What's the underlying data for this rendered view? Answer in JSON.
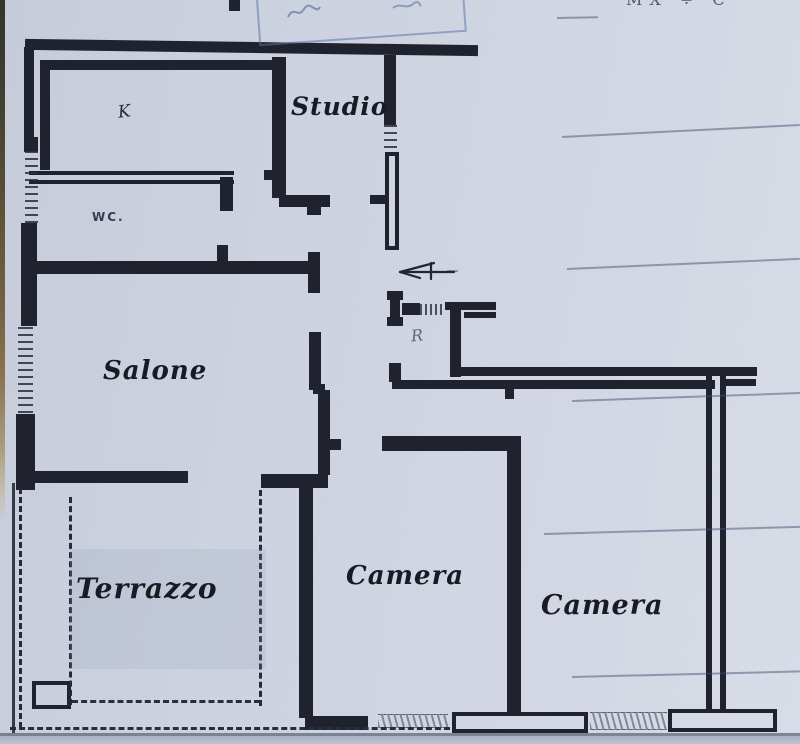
{
  "document": {
    "type": "scanned apartment floor plan",
    "stamp_partial_text": "MX ÷ C"
  },
  "palette": {
    "paper": "#cdd3df",
    "wall": "#20232e",
    "label": "#191b24",
    "stamp_blue": "#5b74ab",
    "faint_line": "rgba(66,75,108,0.48)"
  },
  "rooms": {
    "kitchen": {
      "label": "K"
    },
    "studio": {
      "label": "Studio"
    },
    "wc": {
      "label": "WC."
    },
    "salone": {
      "label": "Salone"
    },
    "terrazzo": {
      "label": "Terrazzo"
    },
    "camera_middle": {
      "label": "Camera"
    },
    "camera_right": {
      "label": "Camera"
    },
    "storage": {
      "label": "R"
    }
  },
  "floorplan": {
    "segments": [
      [
        25,
        42,
        453,
        11,
        "wall",
        0.8
      ],
      [
        24,
        47,
        10,
        92,
        "wall"
      ],
      [
        24,
        137,
        14,
        15,
        "wall"
      ],
      [
        21,
        223,
        16,
        103,
        "wall"
      ],
      [
        16,
        414,
        19,
        76,
        "wall"
      ],
      [
        40,
        60,
        240,
        10,
        "wall"
      ],
      [
        40,
        60,
        10,
        110,
        "wall"
      ],
      [
        220,
        177,
        13,
        34,
        "wall"
      ],
      [
        272,
        57,
        14,
        141,
        "wall"
      ],
      [
        264,
        170,
        10,
        10,
        "wall"
      ],
      [
        279,
        195,
        51,
        12,
        "wall"
      ],
      [
        307,
        205,
        14,
        10,
        "wall"
      ],
      [
        384,
        55,
        12,
        70,
        "wall"
      ],
      [
        370,
        195,
        16,
        9,
        "wall"
      ],
      [
        32,
        261,
        284,
        13,
        "wall"
      ],
      [
        217,
        245,
        11,
        18,
        "wall"
      ],
      [
        308,
        252,
        12,
        41,
        "wall"
      ],
      [
        309,
        332,
        12,
        58,
        "wall"
      ],
      [
        313,
        384,
        12,
        10,
        "wall"
      ],
      [
        318,
        390,
        12,
        85,
        "wall"
      ],
      [
        330,
        439,
        11,
        11,
        "wall"
      ],
      [
        20,
        471,
        168,
        12,
        "wall"
      ],
      [
        261,
        474,
        67,
        14,
        "wall"
      ],
      [
        299,
        488,
        14,
        230,
        "wall"
      ],
      [
        305,
        716,
        63,
        14,
        "wall"
      ],
      [
        382,
        436,
        133,
        15,
        "wall"
      ],
      [
        507,
        436,
        14,
        280,
        "wall"
      ],
      [
        387,
        291,
        16,
        9,
        "wall"
      ],
      [
        390,
        299,
        10,
        20,
        "wall"
      ],
      [
        387,
        317,
        16,
        9,
        "wall"
      ],
      [
        402,
        303,
        18,
        12,
        "wall"
      ],
      [
        445,
        302,
        51,
        8,
        "wall"
      ],
      [
        464,
        312,
        32,
        6,
        "wall"
      ],
      [
        450,
        308,
        11,
        69,
        "wall"
      ],
      [
        389,
        363,
        12,
        19,
        "wall"
      ],
      [
        455,
        367,
        302,
        9,
        "wall"
      ],
      [
        392,
        380,
        323,
        9,
        "wall"
      ],
      [
        721,
        379,
        35,
        7,
        "wall"
      ],
      [
        505,
        389,
        9,
        10,
        "wall"
      ],
      [
        229,
        0,
        11,
        11,
        "wall"
      ],
      [
        29,
        171,
        205,
        13,
        "double"
      ],
      [
        385,
        152,
        14,
        98,
        "hollow"
      ],
      [
        452,
        712,
        136,
        21,
        "hollow"
      ],
      [
        668,
        709,
        109,
        23,
        "hollow"
      ],
      [
        32,
        681,
        39,
        28,
        "hollow"
      ],
      [
        706,
        376,
        20,
        335,
        "hollowv"
      ],
      [
        25,
        151,
        13,
        73,
        "win"
      ],
      [
        18,
        327,
        15,
        88,
        "win"
      ],
      [
        384,
        125,
        13,
        28,
        "win"
      ],
      [
        420,
        304,
        25,
        11,
        "hatchv"
      ],
      [
        378,
        714,
        70,
        14,
        "hatchb"
      ],
      [
        590,
        712,
        77,
        18,
        "hatchb"
      ],
      [
        69,
        497,
        4,
        208,
        "dashv"
      ],
      [
        259,
        490,
        4,
        216,
        "dashv"
      ],
      [
        19,
        488,
        4,
        240,
        "dashv"
      ],
      [
        72,
        700,
        188,
        4,
        "dashh"
      ],
      [
        10,
        727,
        440,
        3,
        "dashh"
      ],
      [
        12,
        483,
        3,
        250,
        "thin"
      ],
      [
        0,
        733,
        800,
        3,
        "edge"
      ],
      [
        557,
        17,
        41,
        2,
        "faint",
        -1
      ],
      [
        562,
        136,
        238,
        2,
        "faint",
        -2.9
      ],
      [
        447,
        270,
        11,
        2,
        "faint",
        0
      ],
      [
        567,
        268,
        233,
        2,
        "faint",
        -2.5
      ],
      [
        572,
        400,
        228,
        2,
        "faint",
        -2.0
      ],
      [
        544,
        533,
        256,
        2,
        "faint",
        -1.6
      ],
      [
        572,
        676,
        228,
        2,
        "faint",
        -1.4
      ]
    ]
  }
}
